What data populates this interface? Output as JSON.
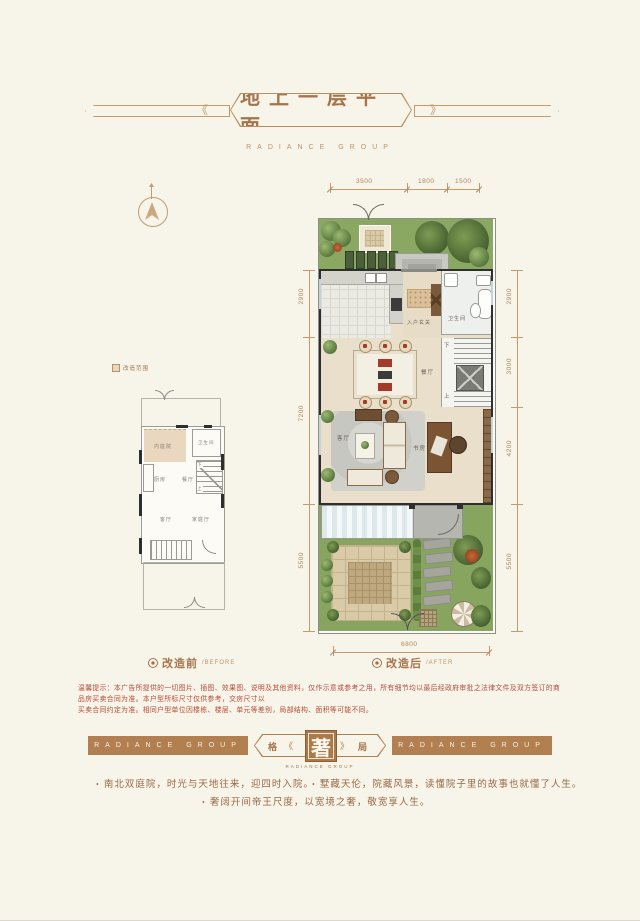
{
  "colors": {
    "background": "#f7f4ea",
    "accent_brown": "#a5744a",
    "ribbon_brown": "#b28050",
    "disclaimer_red": "#bb4a36",
    "garden_green": "#87a55f"
  },
  "icons": {
    "compass": "north-arrow-compass",
    "caption_bullet": "dot-in-circle",
    "legend_square": "shaded-area-swatch"
  },
  "header": {
    "title": "地上一层平面",
    "subtitle": "RADIANCE GROUP"
  },
  "legend": {
    "note": "改造范围"
  },
  "before": {
    "caption": "改造前",
    "caption_en": "/BEFORE",
    "rooms": {
      "courtyard": "内庭院",
      "bath": "卫生间",
      "kitchen": "厨房",
      "dining": "餐厅",
      "living": "客厅",
      "family": "家庭厅",
      "up": "上",
      "down": "下"
    }
  },
  "after": {
    "caption": "改造后",
    "caption_en": "/AFTER",
    "rooms": {
      "entry": "入户玄关",
      "bath": "卫生间",
      "dining": "餐厅",
      "living": "客厅",
      "study": "书房",
      "up": "上",
      "down": "下"
    },
    "dims": {
      "top": [
        "3500",
        "1800",
        "1500"
      ],
      "bottom": [
        "6800"
      ],
      "left": [
        "2900",
        "7200",
        "5500"
      ],
      "right": [
        "2900",
        "3000",
        "4200",
        "5500"
      ]
    }
  },
  "disclaimer": {
    "line1": "温馨提示：本广告所提供的一切图片、插图、效果图、说明及其他资料，仅作示意或参考之用，所有细节均以最后经政府审批之法律文件及双方签订的商品房买卖合同为准。本户型所标尺寸仅供参考，交房尺寸以",
    "line2": "买卖合同约定为准。相同户型单位因楼栋、楼层、单元等差别，局部结构、面积等可能不同。"
  },
  "footer": {
    "ribbon": "RADIANCE GROUP",
    "seal_left": "格",
    "seal_center": "著",
    "seal_right": "局",
    "seal_sub": "RADIANCE GROUP",
    "bullets": [
      "南北双庭院，时光与天地往来，迎四时入院。",
      "墅藏天伦，院藏风景，读懂院子里的故事也就懂了人生。",
      "奢阔开间帝王尺度，以宽境之奢，敬宽享人生。"
    ]
  }
}
